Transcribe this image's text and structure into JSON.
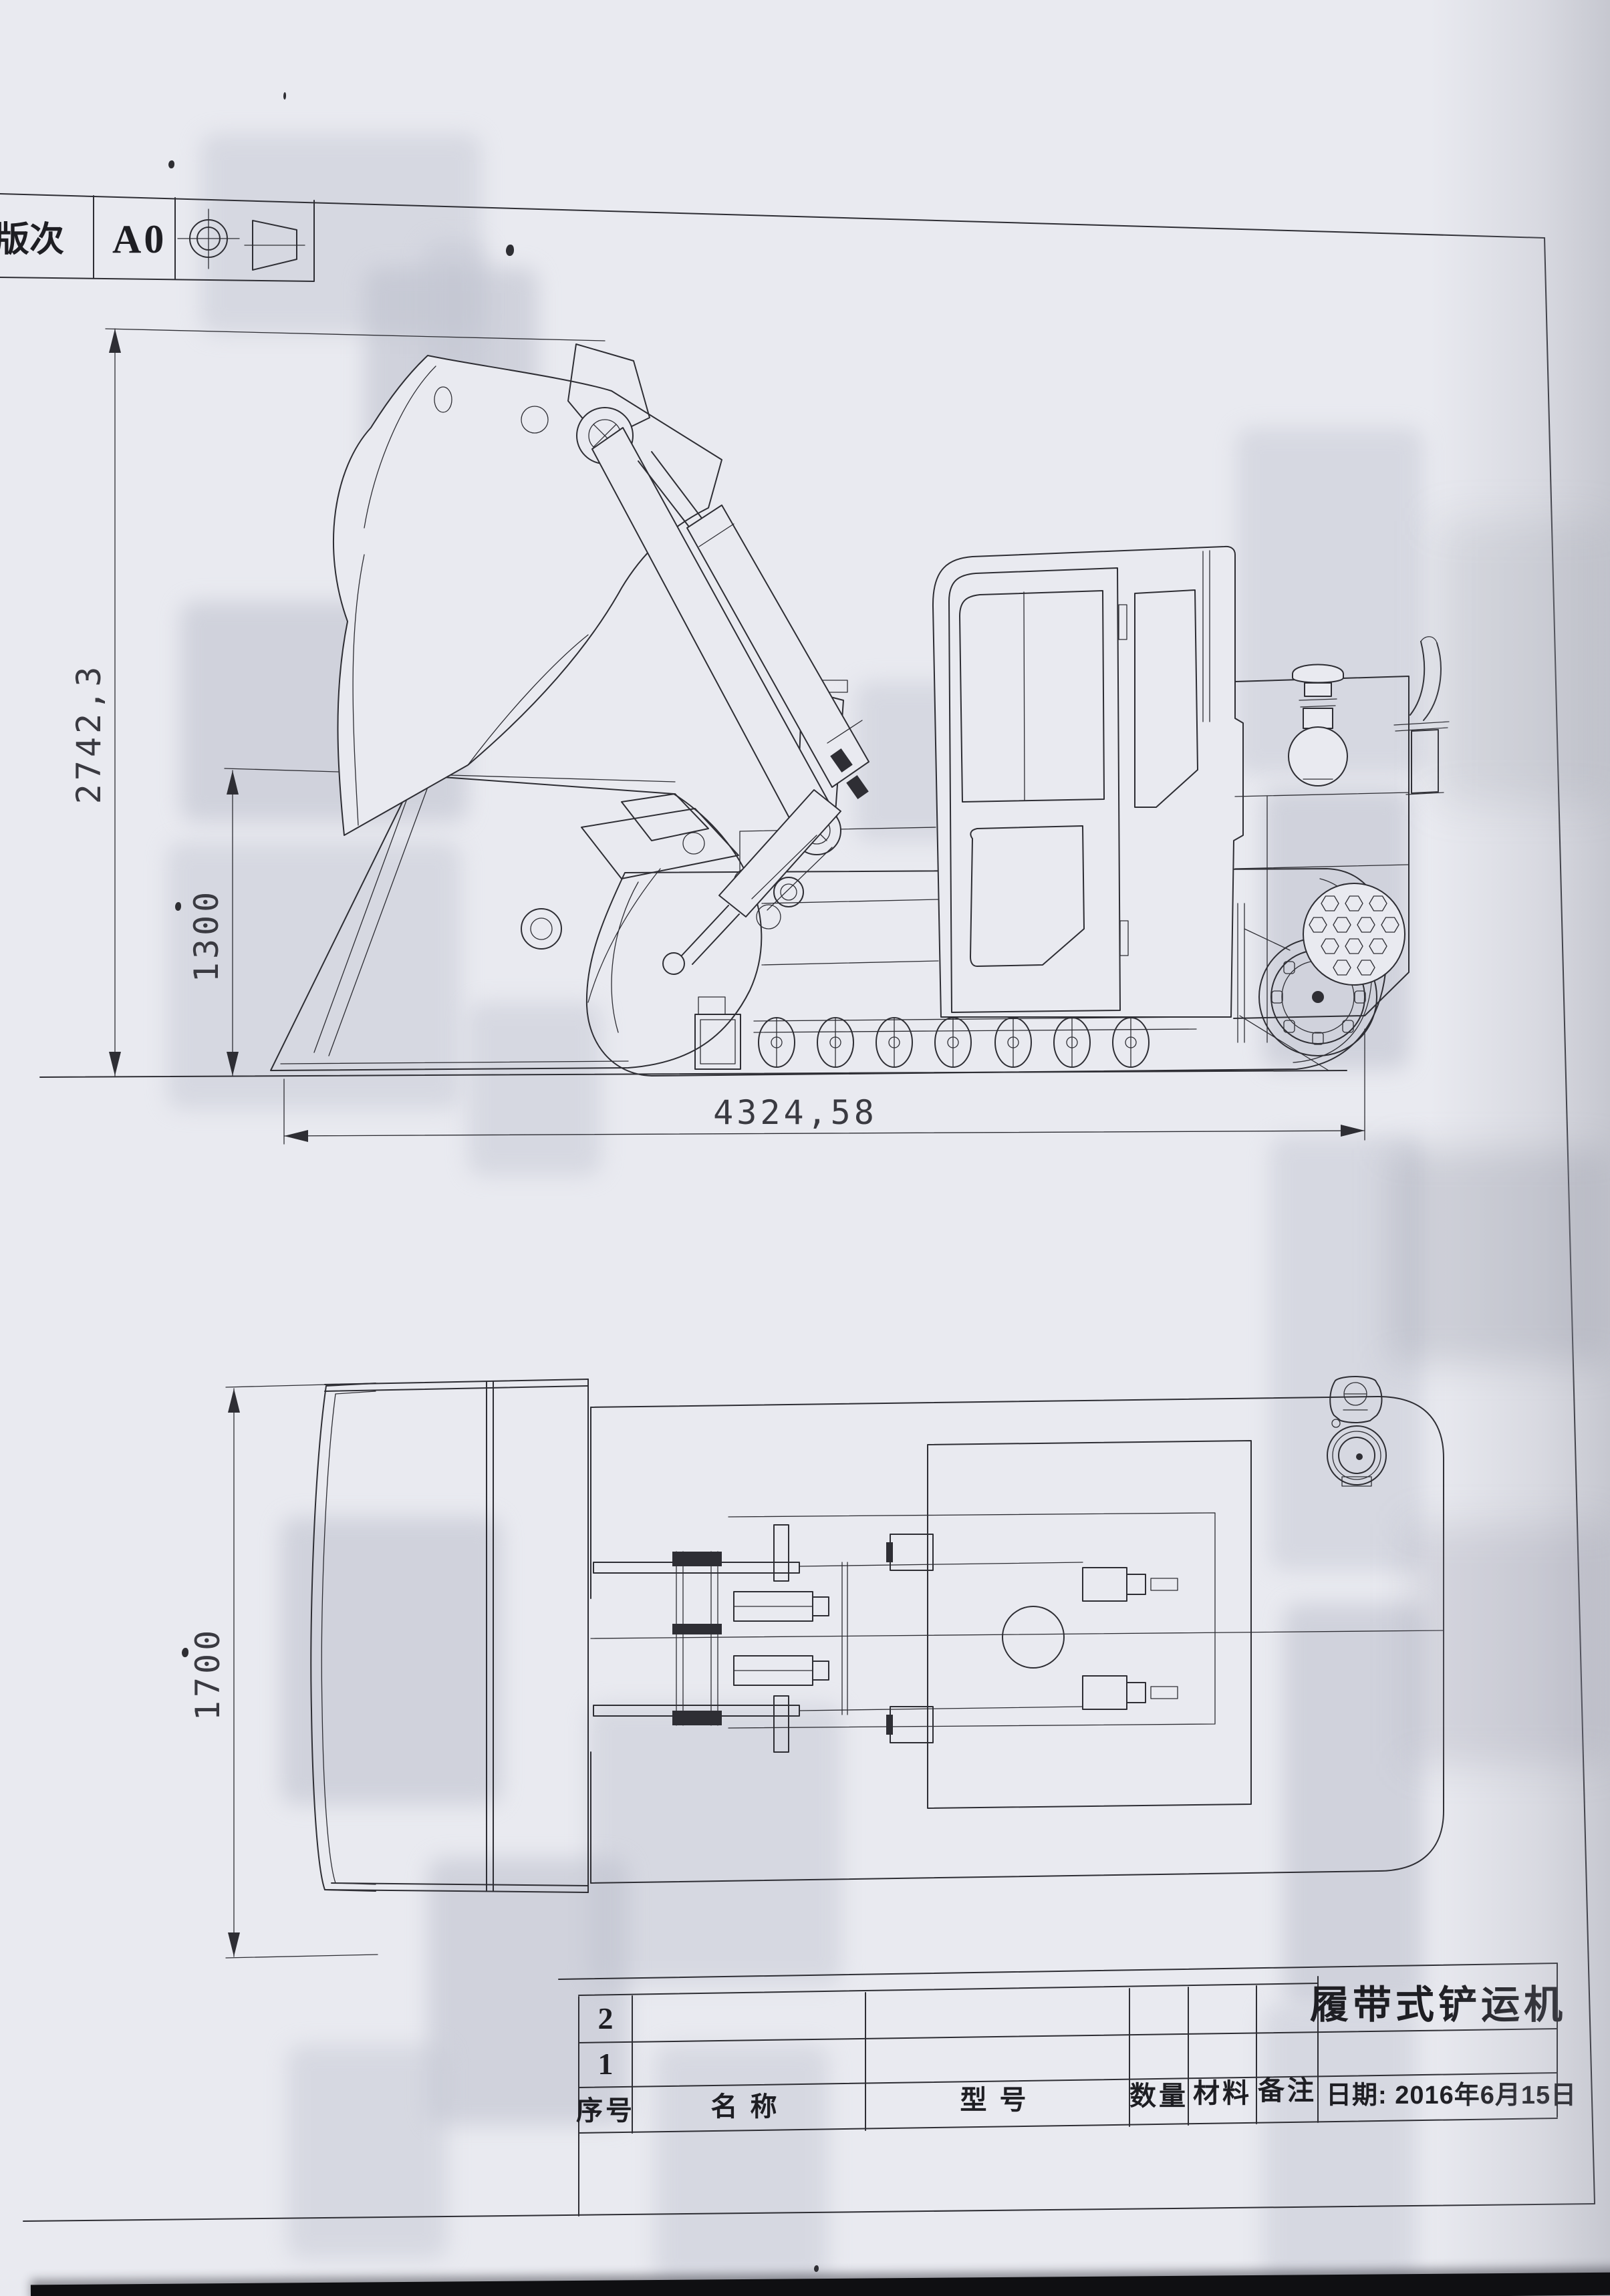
{
  "revision_block": {
    "label": "版次",
    "value": "A0",
    "icons": [
      "first-angle-projection-circle-icon",
      "first-angle-projection-cone-icon"
    ]
  },
  "drawing": {
    "dimensions": {
      "overall_height": "2742,3",
      "bucket_height": "1300",
      "overall_length": "4324,58",
      "overall_width": "1700"
    }
  },
  "title_block": {
    "product_name": "履带式铲运机",
    "date": "日期: 2016年6月15日",
    "columns": {
      "index": "序号",
      "name": "名 称",
      "model": "型 号",
      "quantity": "数量",
      "material": "材料",
      "remark": "备注"
    },
    "item_rows": [
      "2",
      "1"
    ]
  }
}
